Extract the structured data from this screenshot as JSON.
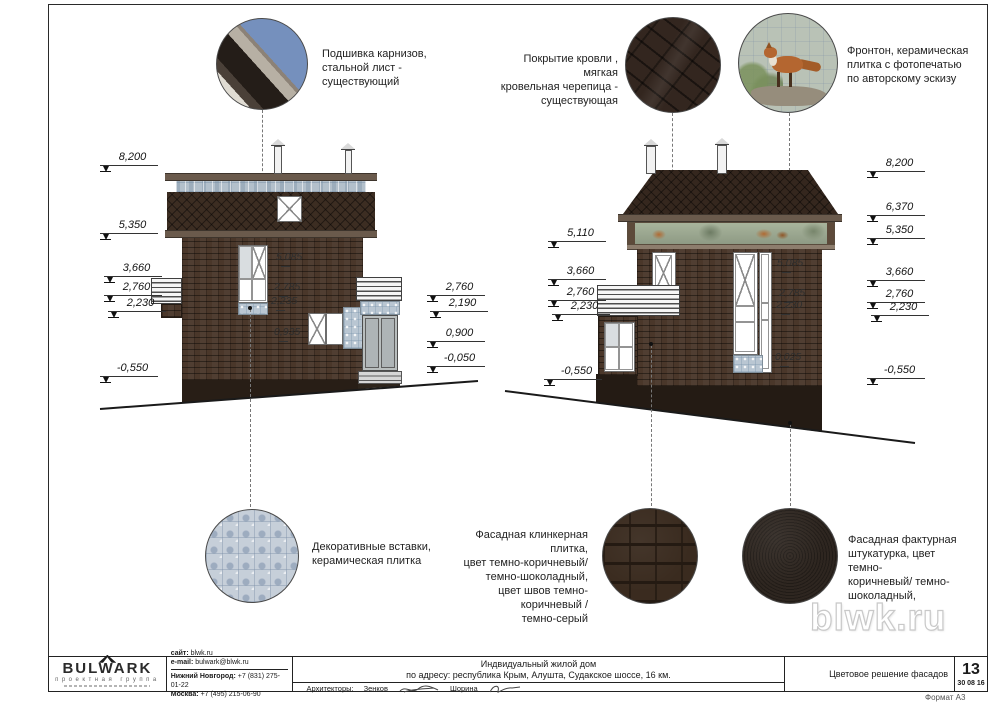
{
  "sheet": {
    "watermark": "blwk.ru",
    "format_label": "Формат А3"
  },
  "callouts": {
    "cornice": "Подшивка карнизов,\nстальной лист -\nсуществующий",
    "roofing": "Покрытие кровли , мягкая\nкровельная черепица -\nсуществующая",
    "pediment": "Фронтон, керамическая\nплитка с фотопечатью\nпо авторскому эскизу",
    "decor_tiles": "Декоративные вставки,\nкерамическая плитка",
    "clinker": "Фасадная клинкерная плитка,\nцвет темно-коричневый/\nтемно-шоколадный,\nцвет швов темно-коричневый /\nтемно-серый",
    "stucco": "Фасадная фактурная\nштукатурка, цвет темно-\nкоричневый/ темно-\nшоколадный,"
  },
  "marks": {
    "lf_left": [
      "8,200",
      "5,350",
      "3,660",
      "2,760",
      "2,230",
      "-0,550"
    ],
    "lf_right": [
      "2,760",
      "2,190",
      "0,900",
      "-0,050"
    ],
    "lf_inner": [
      "5,085",
      "2,785",
      "2,235",
      "0,935"
    ],
    "rf_left": [
      "5,110",
      "3,660",
      "2,760",
      "2,230",
      "-0,550"
    ],
    "rf_right": [
      "8,200",
      "6,370",
      "5,350",
      "3,660",
      "2,760",
      "2,230",
      "-0,550"
    ],
    "rf_inner": [
      "5,085",
      "2,785",
      "2,230",
      "0,025"
    ]
  },
  "titleblock": {
    "logo_name": "BULWARK",
    "logo_subtitle": "проектная группа",
    "site_label": "сайт:",
    "site_value": "blwk.ru",
    "email_label": "e-mail:",
    "email_value": "bulwark@blwk.ru",
    "nn_label": "Нижний Новгород:",
    "nn_value": "+7 (831) 275-01-22",
    "msk_label": "Москва:",
    "msk_value": "+7 (495) 215-06-90",
    "project_title": "Индвидуальный жилой дом",
    "project_address": "по адресу: республика Крым, Алушта, Судакское шоссе, 16 км.",
    "architects_label": "Архитекторы:",
    "architect_1": "Зенков",
    "architect_2": "Шорина",
    "sheet_title": "Цветовое решение фасадов",
    "sheet_number": "13",
    "sheet_date": "30 08 16"
  }
}
